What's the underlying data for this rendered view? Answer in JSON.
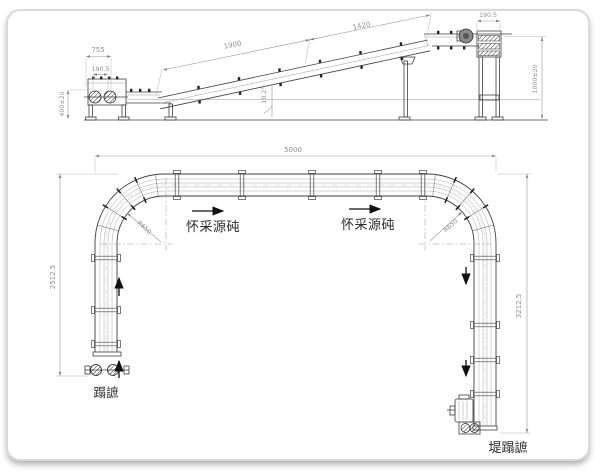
{
  "side_view": {
    "dim_infeed_width": "755",
    "dim_infeed_pulley": "190.5",
    "dim_infeed_height": "400±20",
    "dim_incline_lower": "1900",
    "dim_incline_upper": "1420",
    "dim_incline_angle": "10.2°",
    "dim_discharge_width": "190.5",
    "dim_discharge_height": "1000±20"
  },
  "plan_view": {
    "dim_overall_width": "5000",
    "dim_left_run": "2512.5",
    "dim_right_run": "3212.5",
    "radius_left_label": "R650",
    "radius_right_label": "R650",
    "direction_label_left": "怀采源砘",
    "direction_label_right": "怀采源砘",
    "infeed_label": "蹋謶",
    "discharge_label": "堤蹋謶"
  }
}
